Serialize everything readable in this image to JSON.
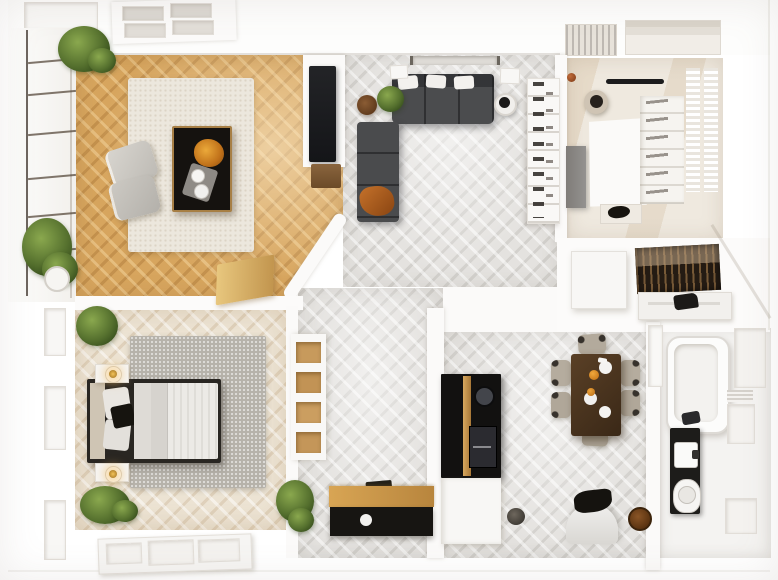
{
  "scene": {
    "title": "Top-down 3D render of a two-bedroom apartment floor plan",
    "style": "photorealistic architectural visualization",
    "view": "top-down",
    "visible_text": "none"
  },
  "palette": {
    "wood_floor": "#d7a55e",
    "gray_floor": "#e4e2df",
    "cream_floor": "#ece3d3",
    "office_floor": "#efe9df",
    "wall_white": "#fbfaf9",
    "sofa_gray": "#4a4b4d",
    "accent_orange": "#c4712a",
    "black_furniture": "#171512",
    "brass": "#c08f4b",
    "plant_green": "#5d7a38",
    "rug_cream": "#ece7dd",
    "rug_gray": "#b6b2aa",
    "table_walnut": "#4a3322",
    "lamp_gold": "#d9a43c"
  },
  "rooms": [
    {
      "id": "living-room",
      "name": "Living room — oak herringbone floor, cream rug, black coffee table with brass edge, two gray poufs"
    },
    {
      "id": "tv-lounge",
      "name": "TV lounge — gray L-shaped sectional sofa, orange throw, media wall with TV, bookshelf"
    },
    {
      "id": "dressing-office",
      "name": "White dressing room / office — L-shaped unit, chair, shoe shelving"
    },
    {
      "id": "wardrobe",
      "name": "Walk-in wardrobe — hanging clothes and counter"
    },
    {
      "id": "bathroom",
      "name": "Bathroom — bathtub, black vanity, washbasin, toilet"
    },
    {
      "id": "kitchen",
      "name": "Kitchenette — black counter with brass trim and round sink"
    },
    {
      "id": "dining-area",
      "name": "Dining area — walnut table with six chairs and tableware"
    },
    {
      "id": "bedroom",
      "name": "Bedroom — dark framed bed, brass lamps, gray textured rug"
    },
    {
      "id": "hallway",
      "name": "Hallway — niche shelving and oak-top console"
    },
    {
      "id": "balcony",
      "name": "Balcony glazing — black mullions and plants"
    }
  ],
  "furniture": {
    "living_room": [
      "area rug",
      "black coffee table with brass edge",
      "orange flower arrangement",
      "tray with cups",
      "two gray poufs",
      "oak bench",
      "potted plants"
    ],
    "tv_lounge": [
      "L-shaped gray sofa",
      "white cushions",
      "orange throw blanket",
      "round wooden side table",
      "black-and-white side table",
      "potted plant",
      "TV on media wall",
      "bookshelf"
    ],
    "dressing_office": [
      "white L-shaped unit",
      "chair",
      "gray dresser",
      "black wall rail",
      "shoe shelving",
      "slatted racks",
      "bench with black garment"
    ],
    "wardrobe": [
      "island cabinet",
      "hanging clothes",
      "counter with black bag"
    ],
    "bathroom": [
      "bathtub with dark faucet",
      "black vanity counter",
      "washbasin",
      "toilet",
      "window panels"
    ],
    "kitchen": [
      "black countertop",
      "brass trim rail",
      "round black sink",
      "built-in module",
      "white base cabinet",
      "floor bowl"
    ],
    "dining_area": [
      "walnut dining table",
      "six upholstered chairs",
      "white plates",
      "orange fruit",
      "rounded armchair",
      "black sculpture",
      "two floor vases"
    ],
    "bedroom": [
      "bed with dark frame",
      "striped white duvet",
      "black accent pillow",
      "two nightstands",
      "two glowing brass lamps",
      "speckled gray rug",
      "potted plants",
      "paneled double door"
    ],
    "hallway": [
      "niche shelving with oak boxes",
      "console with oak top and black drawer",
      "potted plant"
    ],
    "balcony": [
      "glazed wall with black mullions",
      "potted plants",
      "white planter"
    ]
  }
}
